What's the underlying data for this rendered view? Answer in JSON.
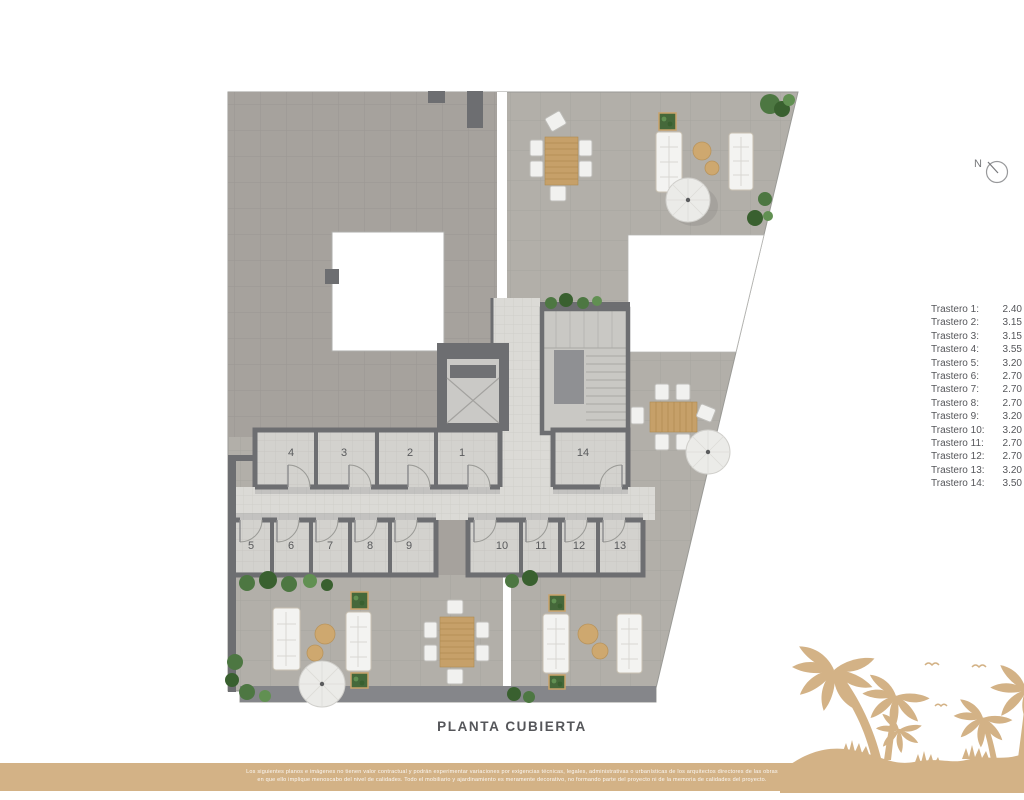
{
  "title": "PLANTA CUBIERTA",
  "north": {
    "label": "N"
  },
  "legend": {
    "items": [
      {
        "label": "Trastero 1:",
        "value": "2.40"
      },
      {
        "label": "Trastero 2:",
        "value": "3.15"
      },
      {
        "label": "Trastero 3:",
        "value": "3.15"
      },
      {
        "label": "Trastero 4:",
        "value": "3.55"
      },
      {
        "label": "Trastero 5:",
        "value": "3.20"
      },
      {
        "label": "Trastero 6:",
        "value": "2.70"
      },
      {
        "label": "Trastero 7:",
        "value": "2.70"
      },
      {
        "label": "Trastero 8:",
        "value": "2.70"
      },
      {
        "label": "Trastero 9:",
        "value": "3.20"
      },
      {
        "label": "Trastero 10:",
        "value": "3.20"
      },
      {
        "label": "Trastero 11:",
        "value": "2.70"
      },
      {
        "label": "Trastero 12:",
        "value": "2.70"
      },
      {
        "label": "Trastero 13:",
        "value": "3.20"
      },
      {
        "label": "Trastero 14:",
        "value": "3.50"
      }
    ]
  },
  "plan": {
    "rooms": [
      "4",
      "3",
      "2",
      "1",
      "14",
      "5",
      "6",
      "7",
      "8",
      "9",
      "10",
      "11",
      "12",
      "13"
    ]
  },
  "footer": {
    "disclaimer_line1": "Los siguientes planos e imágenes no tienen valor contractual y podrán experimentar variaciones por exigencias técnicas, legales, administrativas o urbanísticas de los arquitectos directores de las obras",
    "disclaimer_line2": "en que ello implique menoscabo del nivel de calidades. Todo el mobiliario y ajardinamiento es meramente decorativo, no formando parte del proyecto ni de la memoria de calidades del proyecto."
  },
  "colors": {
    "tan": "#d3b286",
    "ink": "#55565a",
    "wall": "#6d6e71"
  }
}
